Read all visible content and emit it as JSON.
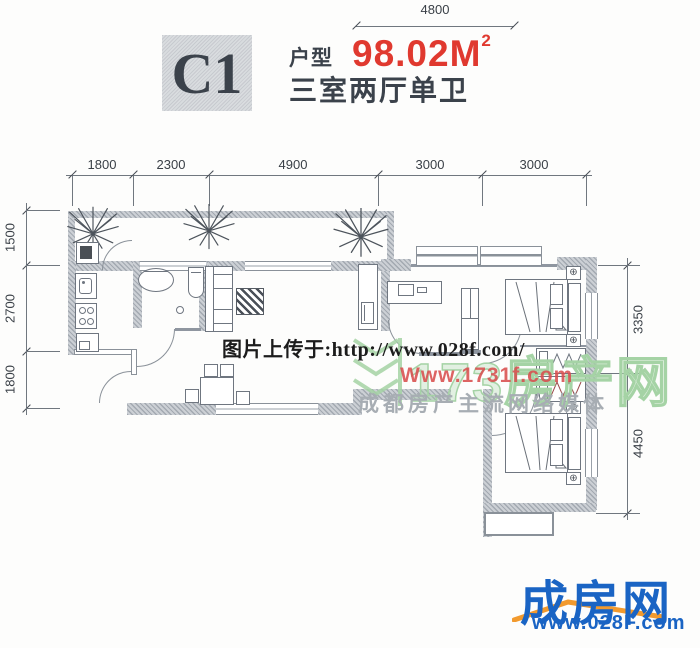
{
  "header": {
    "unit_code": "C1",
    "type_label": "户型",
    "area_value": "98.02M",
    "area_superscript": "2",
    "layout_description": "三室两厅单卫"
  },
  "dimensions": {
    "top_overall": "4800",
    "top_segments": [
      "1800",
      "2300",
      "4900",
      "3000",
      "3000"
    ],
    "left_segments": [
      "1500",
      "2700",
      "1800"
    ],
    "right_segments": [
      "3350",
      "4450"
    ]
  },
  "watermarks": {
    "upload_notice": "图片上传于:http://www.028f.com/",
    "site_name": "173房产网",
    "site_url": "Www.1731f.com",
    "media_slogan": "成都房产主流网络媒体"
  },
  "footer_logo": {
    "brand": "成房网",
    "url": "www.028F.com"
  },
  "symbols": {
    "bedside_lamp_glyph": "⊕"
  },
  "colors": {
    "area_red": "#e0392f",
    "title_dark": "#3b424b",
    "logo_blue": "#1a64c4",
    "logo_orange": "#f29a2e",
    "watermark_green": "#a5d3a5",
    "watermark_red": "#d94f4f",
    "watermark_gray": "#a7adb3",
    "wall_gray": "#aab0b8",
    "line_gray": "#8a9199"
  }
}
